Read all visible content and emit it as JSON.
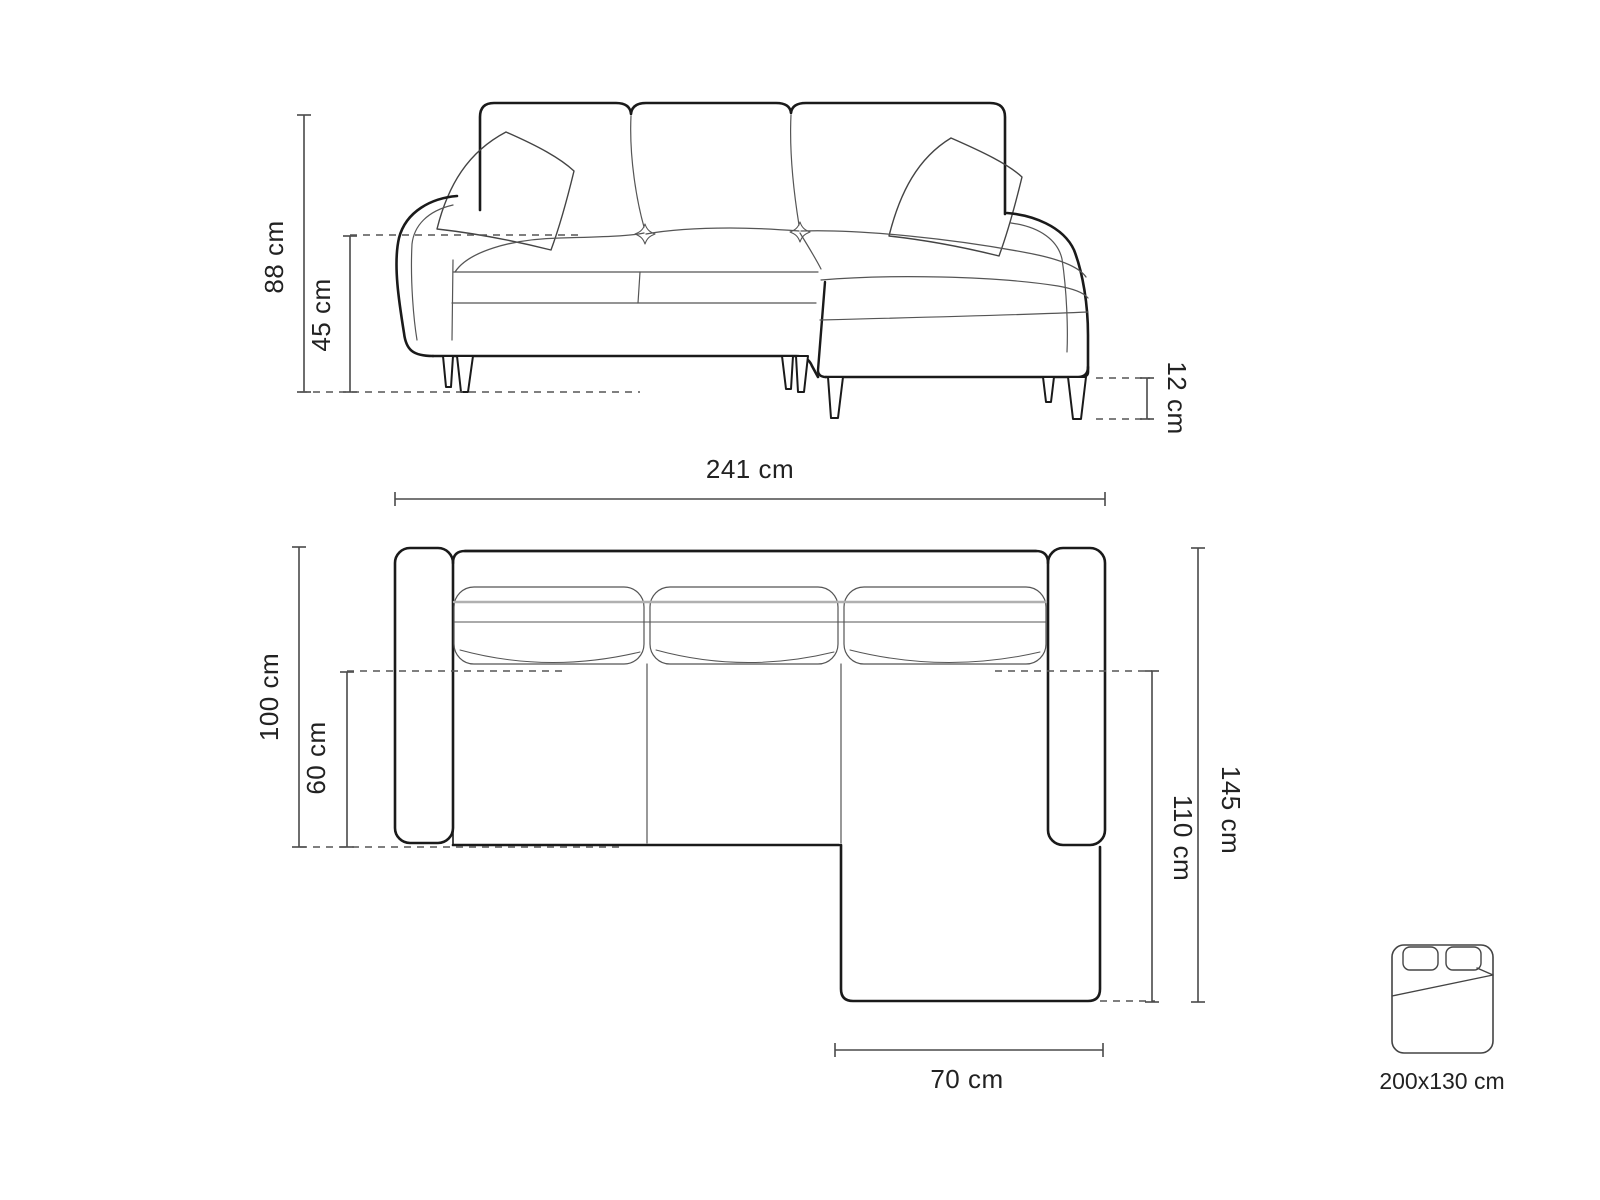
{
  "diagram_title": "corner-sofa-dimension-diagram",
  "front_view": {
    "total_height": "88 cm",
    "seat_height": "45 cm",
    "leg_height": "12 cm"
  },
  "top_view": {
    "total_width": "241 cm",
    "total_depth": "100 cm",
    "seat_depth": "60 cm",
    "chaise_total_depth": "145 cm",
    "chaise_extension_depth": "110 cm",
    "chaise_width": "70 cm"
  },
  "sleeping_area": {
    "size_label": "200x130 cm"
  },
  "colors": {
    "outline_bold": "#1a1a1a",
    "outline_thin": "#555555",
    "dimension_line": "#4a4a4a",
    "dashed_line": "#555555",
    "soft_gray": "#b0b0b0",
    "background": "#ffffff"
  }
}
